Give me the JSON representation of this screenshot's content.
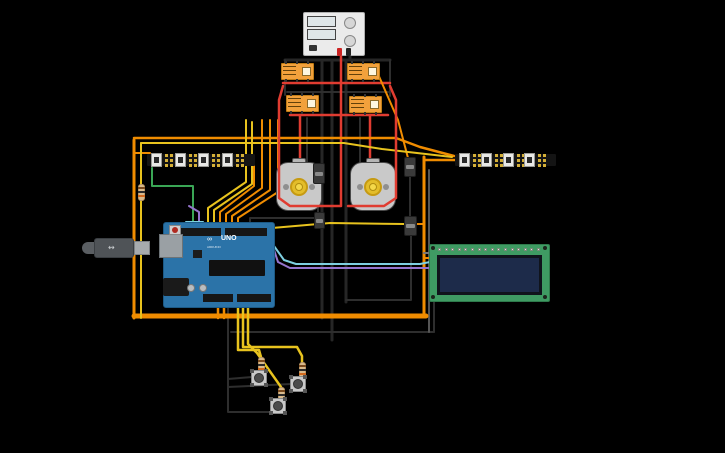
{
  "canvas": {
    "width": 725,
    "height": 453,
    "background": "#000000"
  },
  "text": {
    "arduino_logo": "ARDUINO",
    "arduino_model": "UNO"
  },
  "palette": {
    "wire_red": "#e03c31",
    "wire_black": "#2e2e2e",
    "wire_black_thick": "#262626",
    "wire_orange": "#f08c00",
    "wire_yellow": "#e8c31e",
    "wire_green": "#3aa655",
    "wire_purple": "#9575cd",
    "wire_cyan": "#7ecfe0",
    "wire_grey": "#777777",
    "relay_body": "#f2a13c",
    "motor_body": "#c9c9c9",
    "motor_gear": "#e3bd2a",
    "arduino_board": "#2b73a8",
    "lcd_pcb": "#3f9b63",
    "lcd_screen": "#1d2b4a",
    "supply_body": "#ebebeb",
    "resistor_body": "#d8b98c",
    "strip_black": "#141414",
    "pad_gold": "#d4af37"
  },
  "components": [
    {
      "type": "power-supply",
      "name": "power-supply",
      "x": 303,
      "y": 12,
      "w": 62,
      "h": 44
    },
    {
      "type": "relay",
      "name": "relay-1",
      "x": 281,
      "y": 63,
      "w": 33,
      "h": 17
    },
    {
      "type": "relay",
      "name": "relay-2",
      "x": 347,
      "y": 63,
      "w": 33,
      "h": 17
    },
    {
      "type": "relay",
      "name": "relay-3",
      "x": 286,
      "y": 95,
      "w": 33,
      "h": 17
    },
    {
      "type": "relay",
      "name": "relay-4",
      "x": 349,
      "y": 96,
      "w": 33,
      "h": 17
    },
    {
      "type": "motor",
      "name": "motor-left",
      "x": 276,
      "y": 162,
      "w": 46,
      "h": 49
    },
    {
      "type": "motor",
      "name": "motor-right",
      "x": 350,
      "y": 162,
      "w": 46,
      "h": 49
    },
    {
      "type": "neopixel",
      "name": "neopixel-strip-left",
      "x": 147,
      "y": 151,
      "w": 108,
      "h": 18,
      "leds": 4
    },
    {
      "type": "neopixel",
      "name": "neopixel-strip-right",
      "x": 455,
      "y": 151,
      "w": 101,
      "h": 18,
      "leds": 4
    },
    {
      "type": "arduino",
      "name": "arduino-uno",
      "x": 163,
      "y": 222,
      "w": 112,
      "h": 86
    },
    {
      "type": "usb-cable",
      "name": "usb-cable",
      "x": 82,
      "y": 237,
      "w": 70,
      "h": 22
    },
    {
      "type": "lcd",
      "name": "lcd-16x2",
      "x": 429,
      "y": 244,
      "w": 121,
      "h": 58
    },
    {
      "type": "switch",
      "name": "switch-1",
      "x": 313,
      "y": 163,
      "w": 12,
      "h": 21
    },
    {
      "type": "switch",
      "name": "switch-2",
      "x": 314,
      "y": 212,
      "w": 11,
      "h": 17
    },
    {
      "type": "switch",
      "name": "switch-3",
      "x": 404,
      "y": 157,
      "w": 12,
      "h": 20
    },
    {
      "type": "switch",
      "name": "switch-4",
      "x": 404,
      "y": 216,
      "w": 13,
      "h": 20
    },
    {
      "type": "resistor",
      "name": "resistor-left",
      "x": 138,
      "y": 184,
      "w": 7,
      "h": 17
    },
    {
      "type": "resistor",
      "name": "resistor-1",
      "x": 258,
      "y": 357,
      "w": 7,
      "h": 17
    },
    {
      "type": "resistor",
      "name": "resistor-2",
      "x": 299,
      "y": 362,
      "w": 7,
      "h": 17
    },
    {
      "type": "resistor",
      "name": "resistor-3",
      "x": 278,
      "y": 387,
      "w": 7,
      "h": 17
    },
    {
      "type": "pushbutton",
      "name": "pushbutton-1",
      "x": 251,
      "y": 370,
      "w": 16,
      "h": 16
    },
    {
      "type": "pushbutton",
      "name": "pushbutton-2",
      "x": 290,
      "y": 376,
      "w": 16,
      "h": 16
    },
    {
      "type": "pushbutton",
      "name": "pushbutton-3",
      "x": 270,
      "y": 398,
      "w": 16,
      "h": 16
    }
  ],
  "wires": [
    {
      "name": "wire-black-supply",
      "color": "#262626",
      "width": 3,
      "layer": "under",
      "points": [
        [
          350,
          52
        ],
        [
          350,
          60
        ]
      ]
    },
    {
      "name": "wire-black-toprail",
      "color": "#262626",
      "width": 3,
      "layer": "under",
      "points": [
        [
          285,
          60
        ],
        [
          390,
          60
        ]
      ]
    },
    {
      "name": "wire-black-v1",
      "color": "#262626",
      "width": 3,
      "layer": "under",
      "points": [
        [
          322,
          60
        ],
        [
          322,
          318
        ]
      ]
    },
    {
      "name": "wire-black-v2",
      "color": "#262626",
      "width": 3,
      "layer": "under",
      "points": [
        [
          332,
          60
        ],
        [
          332,
          340
        ]
      ]
    },
    {
      "name": "wire-black-v3",
      "color": "#262626",
      "width": 3,
      "layer": "under",
      "points": [
        [
          346,
          60
        ],
        [
          346,
          302
        ]
      ]
    },
    {
      "name": "wire-black-relay-l",
      "color": "#2e2e2e",
      "width": 2,
      "layer": "under",
      "points": [
        [
          285,
          60
        ],
        [
          285,
          95
        ]
      ]
    },
    {
      "name": "wire-black-relay-r",
      "color": "#2e2e2e",
      "width": 2,
      "layer": "under",
      "points": [
        [
          390,
          60
        ],
        [
          390,
          96
        ]
      ]
    },
    {
      "name": "wire-black-midrail",
      "color": "#2e2e2e",
      "width": 2,
      "layer": "under",
      "points": [
        [
          287,
          92
        ],
        [
          388,
          92
        ]
      ]
    },
    {
      "name": "wire-black-motor-l",
      "color": "#2e2e2e",
      "width": 2,
      "layer": "under",
      "points": [
        [
          307,
          118
        ],
        [
          307,
          162
        ]
      ]
    },
    {
      "name": "wire-black-motor-r",
      "color": "#2e2e2e",
      "width": 2,
      "layer": "under",
      "points": [
        [
          360,
          118
        ],
        [
          360,
          162
        ]
      ]
    },
    {
      "name": "wire-black-sw4",
      "color": "#2e2e2e",
      "width": 2,
      "layer": "under",
      "points": [
        [
          411,
          236
        ],
        [
          411,
          300
        ],
        [
          346,
          300
        ]
      ]
    },
    {
      "name": "wire-black-btn-gnd",
      "color": "#2e2e2e",
      "width": 2,
      "layer": "under",
      "points": [
        [
          228,
          308
        ],
        [
          228,
          412
        ],
        [
          271,
          412
        ],
        [
          271,
          407
        ]
      ]
    },
    {
      "name": "wire-black-btn2",
      "color": "#2e2e2e",
      "width": 2,
      "layer": "under",
      "points": [
        [
          228,
          387
        ],
        [
          291,
          384
        ]
      ]
    },
    {
      "name": "wire-black-btn1",
      "color": "#2e2e2e",
      "width": 2,
      "layer": "under",
      "points": [
        [
          228,
          379
        ],
        [
          252,
          377
        ]
      ]
    },
    {
      "name": "wire-black-bottom",
      "color": "#2e2e2e",
      "width": 2,
      "layer": "under",
      "points": [
        [
          231,
          332
        ],
        [
          434,
          332
        ]
      ]
    },
    {
      "name": "wire-black-lcd-gnd",
      "color": "#2e2e2e",
      "width": 2,
      "layer": "under",
      "points": [
        [
          434,
          332
        ],
        [
          434,
          252
        ]
      ]
    },
    {
      "name": "wire-grey-right-v",
      "color": "#555555",
      "width": 2,
      "layer": "under",
      "points": [
        [
          429,
          170
        ],
        [
          429,
          332
        ]
      ]
    },
    {
      "name": "wire-black-sw12",
      "color": "#2e2e2e",
      "width": 2,
      "layer": "under",
      "points": [
        [
          318,
          184
        ],
        [
          318,
          212
        ]
      ]
    },
    {
      "name": "wire-black-sw34",
      "color": "#2e2e2e",
      "width": 2,
      "layer": "under",
      "points": [
        [
          410,
          177
        ],
        [
          410,
          216
        ]
      ]
    },
    {
      "name": "wire-black-d13",
      "color": "#2e2e2e",
      "width": 2,
      "layer": "under",
      "points": [
        [
          250,
          232
        ],
        [
          250,
          218
        ],
        [
          320,
          218
        ]
      ]
    },
    {
      "name": "wire-red-supply",
      "color": "#e03c31",
      "width": 2.5,
      "layer": "under",
      "points": [
        [
          341,
          52
        ],
        [
          341,
          205
        ]
      ]
    },
    {
      "name": "wire-red-rail1",
      "color": "#e03c31",
      "width": 2.5,
      "layer": "under",
      "points": [
        [
          283,
          83
        ],
        [
          390,
          83
        ]
      ]
    },
    {
      "name": "wire-red-rail2",
      "color": "#e03c31",
      "width": 2.5,
      "layer": "under",
      "points": [
        [
          290,
          115
        ],
        [
          388,
          115
        ]
      ]
    },
    {
      "name": "wire-red-motor-l",
      "color": "#e03c31",
      "width": 2.5,
      "layer": "under",
      "points": [
        [
          300,
          115
        ],
        [
          300,
          163
        ]
      ]
    },
    {
      "name": "wire-red-motor-r",
      "color": "#e03c31",
      "width": 2.5,
      "layer": "under",
      "points": [
        [
          370,
          115
        ],
        [
          370,
          163
        ]
      ]
    },
    {
      "name": "wire-orange-left-v",
      "color": "#f08c00",
      "width": 3,
      "layer": "under",
      "points": [
        [
          134,
          140
        ],
        [
          134,
          318
        ]
      ]
    },
    {
      "name": "wire-orange-bus",
      "color": "#f08c00",
      "width": 5,
      "layer": "under",
      "points": [
        [
          134,
          316
        ],
        [
          426,
          316
        ]
      ]
    },
    {
      "name": "wire-orange-right-v",
      "color": "#f08c00",
      "width": 3,
      "layer": "under",
      "points": [
        [
          424,
          316
        ],
        [
          424,
          157
        ]
      ]
    },
    {
      "name": "wire-orange-strip-r",
      "color": "#f08c00",
      "width": 2.5,
      "layer": "under",
      "points": [
        [
          424,
          160
        ],
        [
          456,
          160
        ]
      ]
    },
    {
      "name": "wire-orange-top",
      "color": "#f08c00",
      "width": 2.5,
      "layer": "under",
      "points": [
        [
          134,
          138
        ],
        [
          396,
          138
        ],
        [
          420,
          147
        ],
        [
          454,
          156
        ]
      ]
    },
    {
      "name": "wire-orange-d1",
      "color": "#f08c00",
      "width": 2,
      "layer": "under",
      "points": [
        [
          220,
          232
        ],
        [
          220,
          212
        ],
        [
          254,
          186
        ],
        [
          254,
          164
        ]
      ]
    },
    {
      "name": "wire-orange-d2",
      "color": "#f08c00",
      "width": 2,
      "layer": "under",
      "points": [
        [
          226,
          232
        ],
        [
          226,
          214
        ],
        [
          262,
          188
        ],
        [
          262,
          120
        ]
      ]
    },
    {
      "name": "wire-orange-d3",
      "color": "#f08c00",
      "width": 2,
      "layer": "under",
      "points": [
        [
          232,
          232
        ],
        [
          232,
          216
        ],
        [
          270,
          190
        ],
        [
          270,
          120
        ]
      ]
    },
    {
      "name": "wire-orange-d4",
      "color": "#f08c00",
      "width": 2,
      "layer": "under",
      "points": [
        [
          238,
          232
        ],
        [
          238,
          218
        ],
        [
          278,
          192
        ],
        [
          278,
          120
        ]
      ]
    },
    {
      "name": "wire-orange-b1",
      "color": "#f08c00",
      "width": 2.5,
      "layer": "under",
      "points": [
        [
          218,
          304
        ],
        [
          218,
          318
        ]
      ]
    },
    {
      "name": "wire-orange-b2",
      "color": "#f08c00",
      "width": 2.5,
      "layer": "under",
      "points": [
        [
          224,
          304
        ],
        [
          224,
          318
        ]
      ]
    },
    {
      "name": "wire-orange-sw3",
      "color": "#f08c00",
      "width": 2,
      "layer": "under",
      "points": [
        [
          378,
          74
        ],
        [
          398,
          120
        ],
        [
          408,
          158
        ]
      ]
    },
    {
      "name": "wire-orange-sw4",
      "color": "#f08c00",
      "width": 2,
      "layer": "under",
      "points": [
        [
          415,
          224
        ],
        [
          424,
          224
        ]
      ]
    },
    {
      "name": "wire-orange-lcd",
      "color": "#f08c00",
      "width": 2,
      "layer": "under",
      "points": [
        [
          424,
          258
        ],
        [
          432,
          258
        ]
      ]
    },
    {
      "name": "wire-orange-strip-l",
      "color": "#f08c00",
      "width": 2,
      "layer": "under",
      "points": [
        [
          134,
          153
        ],
        [
          150,
          153
        ]
      ]
    },
    {
      "name": "wire-yellow-d5",
      "color": "#e8c31e",
      "width": 2,
      "layer": "under",
      "points": [
        [
          208,
          232
        ],
        [
          208,
          208
        ],
        [
          246,
          182
        ],
        [
          246,
          120
        ]
      ]
    },
    {
      "name": "wire-yellow-d6",
      "color": "#e8c31e",
      "width": 2,
      "layer": "under",
      "points": [
        [
          214,
          232
        ],
        [
          214,
          210
        ],
        [
          252,
          184
        ],
        [
          252,
          122
        ]
      ]
    },
    {
      "name": "wire-yellow-sw2",
      "color": "#e8c31e",
      "width": 2,
      "layer": "under",
      "points": [
        [
          272,
          228
        ],
        [
          330,
          223
        ],
        [
          404,
          224
        ]
      ]
    },
    {
      "name": "wire-yellow-top",
      "color": "#e8c31e",
      "width": 2,
      "layer": "under",
      "points": [
        [
          141,
          143
        ],
        [
          344,
          143
        ],
        [
          382,
          149
        ],
        [
          452,
          157
        ]
      ]
    },
    {
      "name": "wire-yellow-res-top",
      "color": "#e8c31e",
      "width": 2,
      "layer": "under",
      "points": [
        [
          141,
          143
        ],
        [
          141,
          184
        ]
      ]
    },
    {
      "name": "wire-yellow-res-bot",
      "color": "#e8c31e",
      "width": 2,
      "layer": "under",
      "points": [
        [
          141,
          201
        ],
        [
          141,
          318
        ]
      ]
    },
    {
      "name": "wire-yellow-btn1",
      "color": "#e8c31e",
      "width": 2.5,
      "layer": "under",
      "points": [
        [
          238,
          304
        ],
        [
          238,
          350
        ],
        [
          259,
          350
        ],
        [
          261,
          357
        ]
      ]
    },
    {
      "name": "wire-yellow-btn2",
      "color": "#e8c31e",
      "width": 2.5,
      "layer": "under",
      "points": [
        [
          243,
          304
        ],
        [
          243,
          347
        ],
        [
          297,
          347
        ],
        [
          302,
          356
        ],
        [
          302,
          362
        ]
      ]
    },
    {
      "name": "wire-yellow-btn3",
      "color": "#e8c31e",
      "width": 2.5,
      "layer": "under",
      "points": [
        [
          248,
          304
        ],
        [
          248,
          344
        ],
        [
          257,
          353
        ],
        [
          281,
          387
        ]
      ]
    },
    {
      "name": "wire-green-strip",
      "color": "#3aa655",
      "width": 2,
      "layer": "under",
      "points": [
        [
          152,
          168
        ],
        [
          152,
          186
        ],
        [
          193,
          186
        ],
        [
          193,
          232
        ]
      ]
    },
    {
      "name": "wire-purple-lcd",
      "color": "#9575cd",
      "width": 2,
      "layer": "under",
      "points": [
        [
          274,
          250
        ],
        [
          278,
          262
        ],
        [
          290,
          268
        ],
        [
          430,
          268
        ]
      ]
    },
    {
      "name": "wire-purple-stub",
      "color": "#9575cd",
      "width": 2,
      "layer": "under",
      "points": [
        [
          199,
          232
        ],
        [
          199,
          212
        ],
        [
          189,
          206
        ]
      ]
    },
    {
      "name": "wire-cyan-lcd",
      "color": "#7ecfe0",
      "width": 2,
      "layer": "under",
      "points": [
        [
          274,
          246
        ],
        [
          284,
          260
        ],
        [
          296,
          264
        ],
        [
          420,
          264
        ],
        [
          430,
          262
        ]
      ]
    },
    {
      "name": "wire-cyan-stub",
      "color": "#7ecfe0",
      "width": 2,
      "layer": "under",
      "points": [
        [
          186,
          222
        ],
        [
          203,
          222
        ],
        [
          203,
          232
        ]
      ]
    },
    {
      "name": "wire-grey-lcd",
      "color": "#777777",
      "width": 2,
      "layer": "under",
      "points": [
        [
          424,
          253
        ],
        [
          432,
          253
        ]
      ]
    },
    {
      "name": "wire-red-loop-left",
      "color": "#e03c31",
      "width": 2.5,
      "layer": "over",
      "points": [
        [
          283,
          86
        ],
        [
          279,
          100
        ],
        [
          279,
          198
        ],
        [
          290,
          206
        ],
        [
          341,
          206
        ]
      ]
    },
    {
      "name": "wire-red-loop-right",
      "color": "#e03c31",
      "width": 2.5,
      "layer": "over",
      "points": [
        [
          390,
          86
        ],
        [
          396,
          100
        ],
        [
          396,
          198
        ],
        [
          384,
          206
        ],
        [
          348,
          206
        ]
      ]
    }
  ]
}
